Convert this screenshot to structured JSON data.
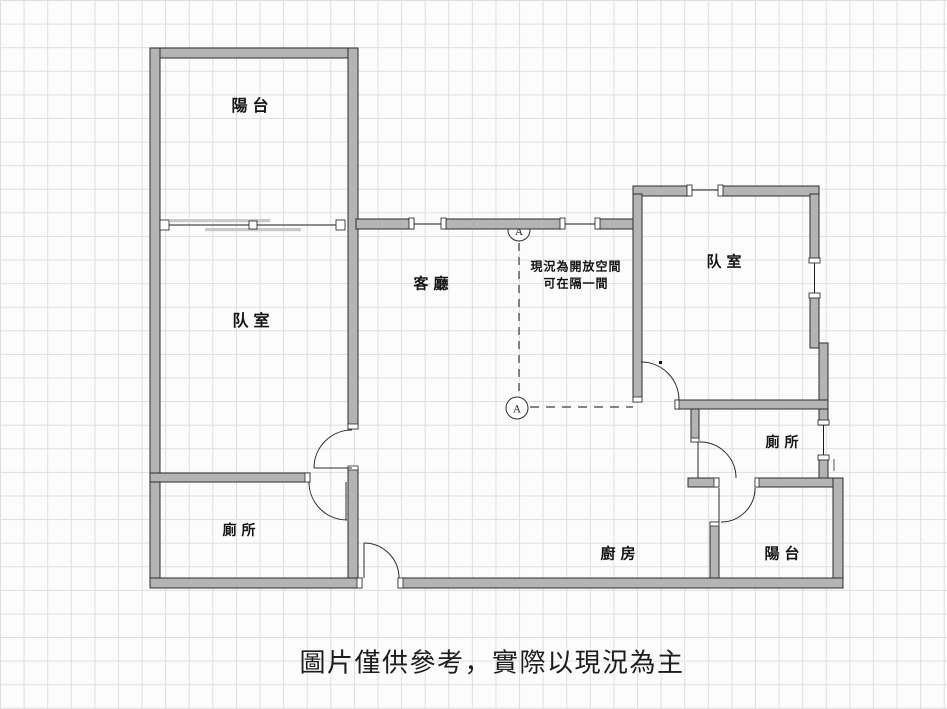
{
  "floorplan": {
    "rooms": [
      {
        "name": "balcony-top-left",
        "label": "陽台"
      },
      {
        "name": "bedroom-left",
        "label": "队室"
      },
      {
        "name": "living-room",
        "label": "客廳"
      },
      {
        "name": "bedroom-right",
        "label": "队室"
      },
      {
        "name": "toilet-right",
        "label": "廁所"
      },
      {
        "name": "balcony-bottom-right",
        "label": "陽台"
      },
      {
        "name": "kitchen",
        "label": "廚房"
      },
      {
        "name": "toilet-left",
        "label": "廁所"
      }
    ],
    "annotation": {
      "line1": "現況為開放空間",
      "line2": "可在隔一間"
    },
    "markers": {
      "top": "A",
      "bottom": "A"
    },
    "caption": "圖片僅供參考，實際以現況為主",
    "colors": {
      "wall_fill": "#b4b4b4",
      "wall_outline": "#2d2d2d",
      "grid_line": "#dedede",
      "canvas": "#fcfcfc",
      "dash_line": "#3c3c3c"
    }
  }
}
